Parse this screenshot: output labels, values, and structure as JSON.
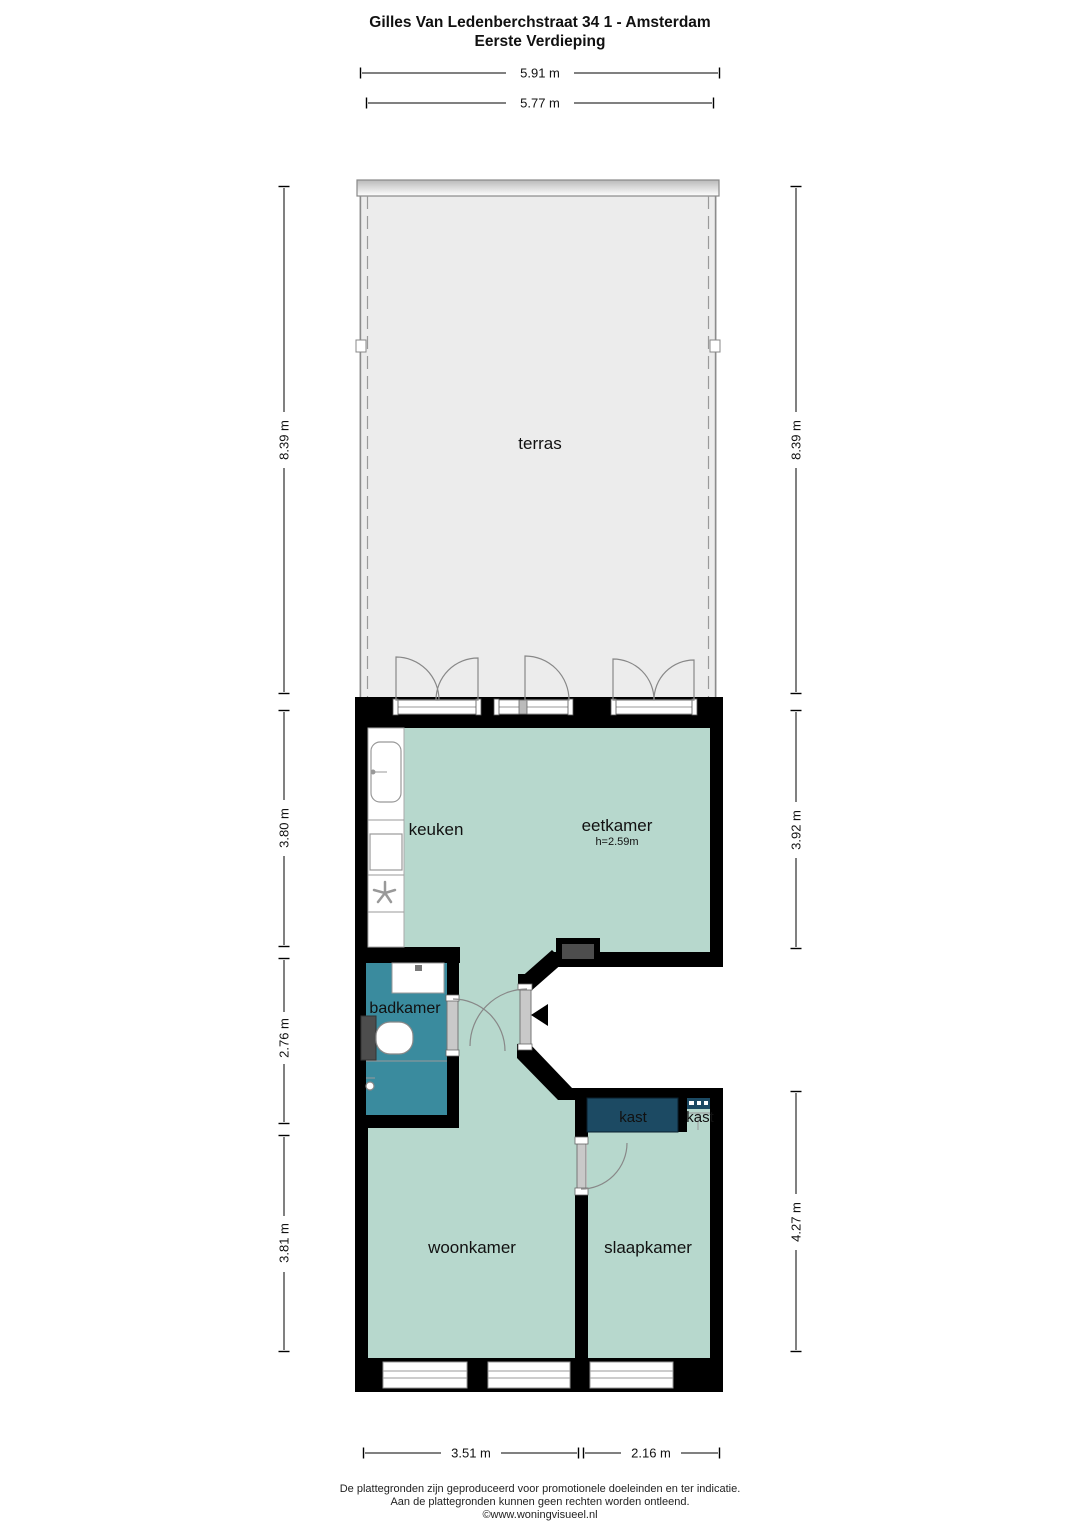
{
  "title": {
    "line1": "Gilles Van Ledenberchstraat 34 1 - Amsterdam",
    "line2": "Eerste Verdieping"
  },
  "rooms": {
    "terras": "terras",
    "keuken": "keuken",
    "eetkamer": "eetkamer",
    "eetkamer_height": "h=2.59m",
    "badkamer": "badkamer",
    "kast_large": "kast",
    "kast_small": "kast",
    "woonkamer": "woonkamer",
    "slaapkamer": "slaapkamer"
  },
  "dimensions": {
    "top_outer": "5.91 m",
    "top_inner": "5.77 m",
    "left_terras": "8.39 m",
    "left_keuken": "3.80 m",
    "left_badkamer": "2.76 m",
    "left_woonkamer": "3.81 m",
    "right_terras": "8.39 m",
    "right_eetkamer": "3.92 m",
    "right_slaapkamer": "4.27 m",
    "bottom_woonkamer": "3.51 m",
    "bottom_slaapkamer": "2.16 m"
  },
  "footer": {
    "line1": "De plattegronden zijn geproduceerd voor promotionele doeleinden en ter indicatie.",
    "line2": "Aan de plattegronden kunnen geen rechten worden ontleend.",
    "line3": "©www.woningvisueel.nl"
  },
  "colors": {
    "floor": "#b7d8cd",
    "bathroom": "#3a8b9e",
    "closet": "#1c4a63",
    "terrace": "#ececec",
    "wall": "#000000",
    "fixture_gray": "#4d4d4d"
  }
}
